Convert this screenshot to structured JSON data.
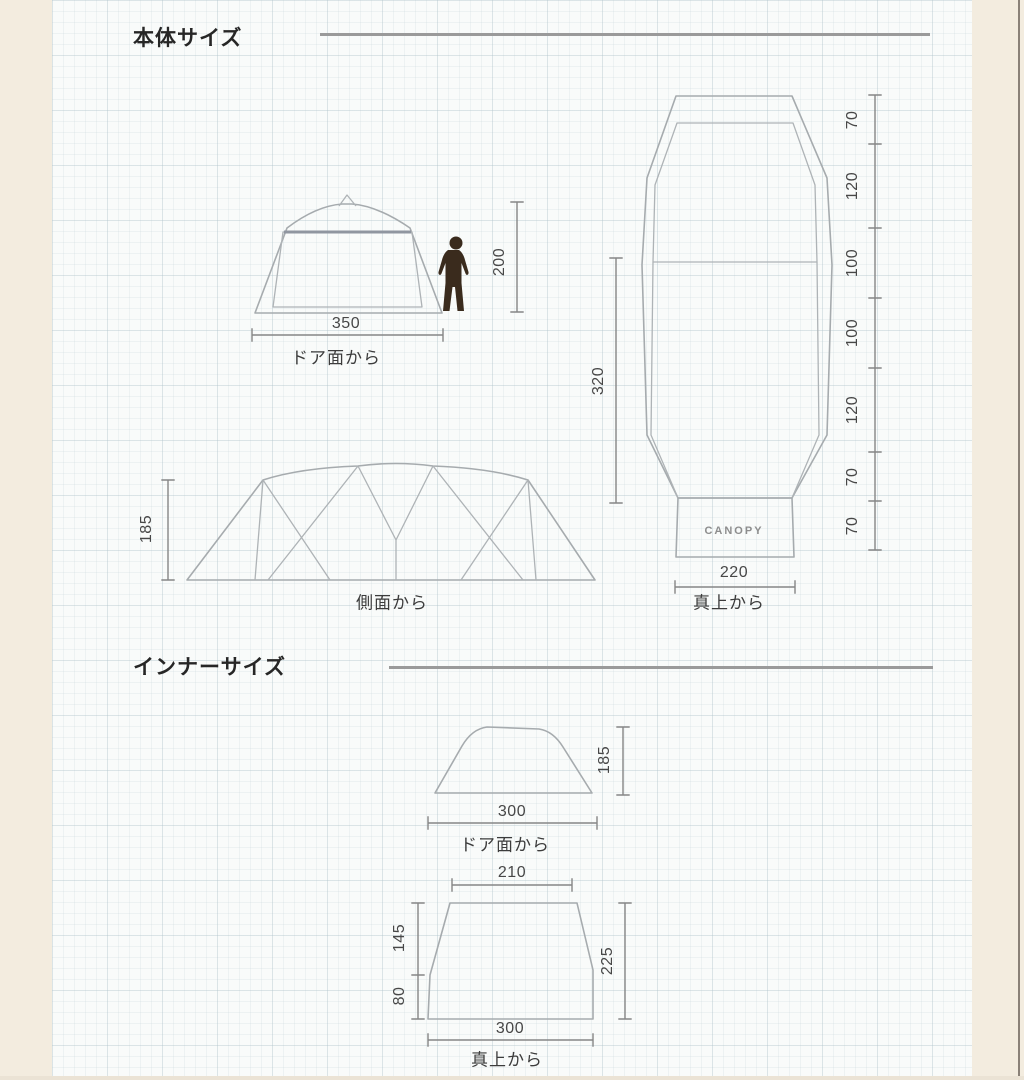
{
  "colors": {
    "margin_bg": "#f3ecdf",
    "paper_bg": "#f9fbfa",
    "outline": "#a6abae",
    "dimension_line": "#868686",
    "dimension_text": "#474747",
    "title_text": "#262626",
    "person_fill": "#3a2b1d",
    "canopy_text": "#8d8d8d"
  },
  "sections": {
    "body": {
      "title": "本体サイズ"
    },
    "inner": {
      "title": "インナーサイズ"
    }
  },
  "body": {
    "front": {
      "width": "350",
      "view_label": "ドア面から",
      "person_height": "200"
    },
    "side": {
      "height": "185",
      "view_label": "側面から"
    },
    "top": {
      "length": "320",
      "canopy_width": "220",
      "view_label": "真上から",
      "canopy_label": "CANOPY",
      "segments": [
        "70",
        "120",
        "100",
        "100",
        "120",
        "70",
        "70"
      ]
    }
  },
  "inner": {
    "front": {
      "width": "300",
      "height": "185",
      "view_label": "ドア面から"
    },
    "top": {
      "top_width": "210",
      "bottom_width": "300",
      "left_upper": "145",
      "left_lower": "80",
      "right_side": "225",
      "view_label": "真上から"
    }
  }
}
